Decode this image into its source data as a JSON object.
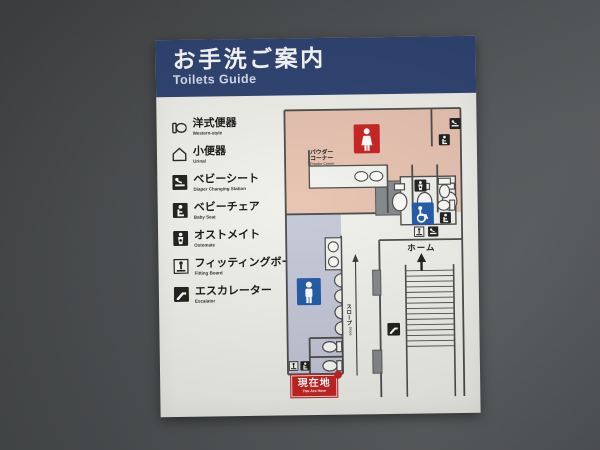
{
  "header": {
    "title_jp": "お手洗ご案内",
    "title_en": "Toilets Guide"
  },
  "legend": {
    "items": [
      {
        "jp": "洋式便器",
        "en": "Western-style",
        "icon": "western-toilet-icon"
      },
      {
        "jp": "小便器",
        "en": "Urinal",
        "icon": "urinal-icon"
      },
      {
        "jp": "ベビーシート",
        "en": "Diaper Changing Station",
        "icon": "diaper-changing-station-icon"
      },
      {
        "jp": "ベビーチェア",
        "en": "Baby Seat",
        "icon": "baby-seat-icon"
      },
      {
        "jp": "オストメイト",
        "en": "Ostomate",
        "icon": "ostomate-icon"
      },
      {
        "jp": "フィッティングボード",
        "en": "Fitting Board",
        "icon": "fitting-board-icon"
      },
      {
        "jp": "エスカレーター",
        "en": "Escalator",
        "icon": "escalator-icon"
      }
    ]
  },
  "map": {
    "powder_corner": {
      "jp_line1": "パウダー",
      "jp_line2": "コーナー",
      "en": "Powder Corner"
    },
    "platform": {
      "jp": "ホーム"
    },
    "slope": {
      "jp": "スロープ",
      "en": "Slope"
    },
    "you_are_here": {
      "jp": "現在地",
      "en": "You Are Here"
    }
  },
  "colors": {
    "header_navy": "#2c4170",
    "women_area_pink": "#e8c2b0",
    "men_area_lavender": "#c4c8d8",
    "signal_red": "#c8201f",
    "signal_blue": "#2059a8",
    "wall_line": "#4a4a4a",
    "pillar_gray": "#85888b",
    "sign_background": "#f1f1ec"
  }
}
